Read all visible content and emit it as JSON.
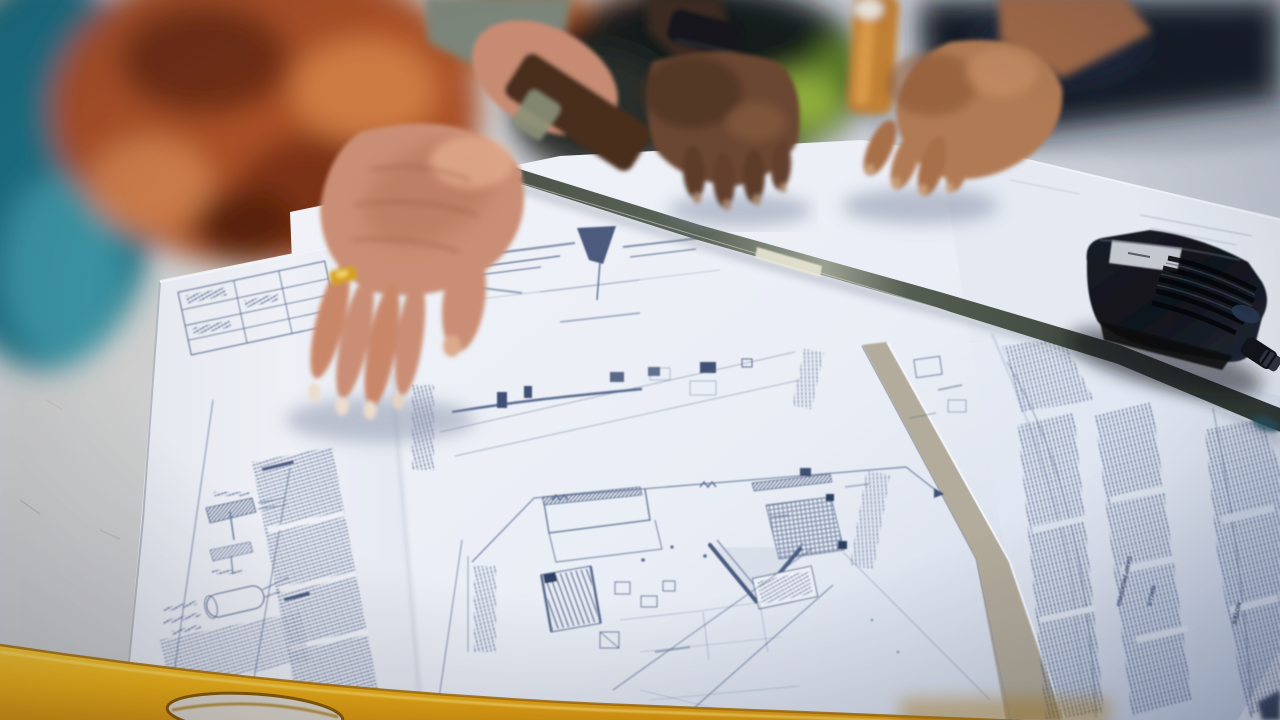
{
  "photo": {
    "description": "Close-up of three people's hands reviewing architectural blueprint sheets spread on a table, with a metal straightedge, a black handheld device and a yellow spirit level",
    "blueprint_text": {
      "notes_header": "NOTES",
      "walls_header": "WALLS",
      "damp_header": "DAMP PROOFING"
    },
    "palette": {
      "table": "#c6cbd4",
      "paper": "#edf0f6",
      "blueprint_ink": "#4c5f86",
      "ruler_metal": "#4a524a",
      "level_yellow": "#f2b416",
      "device_black": "#14171e",
      "skin_light": "#c98e74",
      "skin_dark": "#5d3c2a",
      "skin_tan": "#b07a54",
      "fabric_teal": "#2a7c8e",
      "bokeh_terracotta": "#a84f26",
      "clothing_navy": "#161b26"
    }
  }
}
